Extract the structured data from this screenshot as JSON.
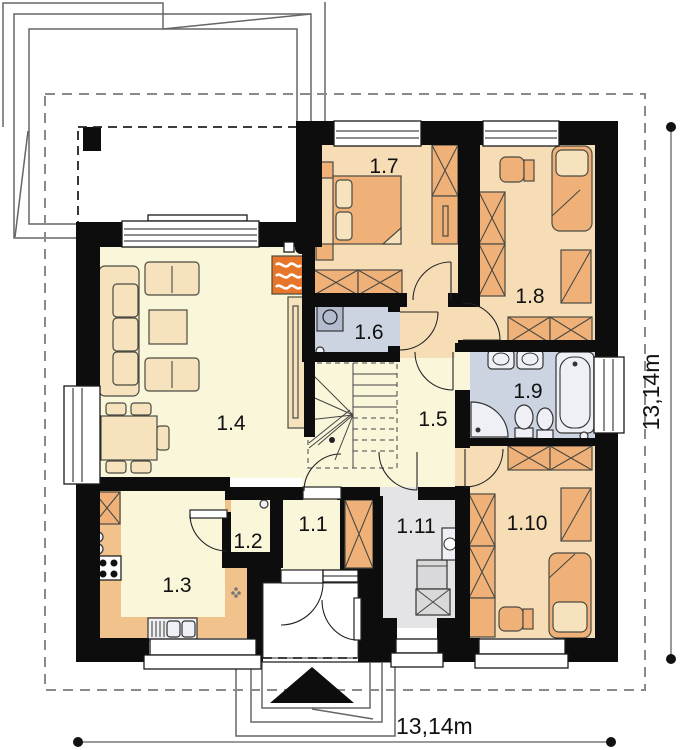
{
  "plan": {
    "dimension_bottom": "13,14m",
    "dimension_right": "13,14m",
    "rooms": [
      {
        "label": "1.1"
      },
      {
        "label": "1.2"
      },
      {
        "label": "1.3"
      },
      {
        "label": "1.4"
      },
      {
        "label": "1.5"
      },
      {
        "label": "1.6"
      },
      {
        "label": "1.7"
      },
      {
        "label": "1.8"
      },
      {
        "label": "1.9"
      },
      {
        "label": "1.10"
      },
      {
        "label": "1.11"
      }
    ],
    "colors": {
      "wall": "#0d0d0d",
      "floor_bedroom": "#f7ddb6",
      "floor_living": "#faf6da",
      "floor_kitchen": "#f2c28c",
      "floor_bathroom": "#ccd4e2",
      "floor_utility": "#e4e4e6",
      "furniture": "#f0b179",
      "furniture_light": "#f6e3bd",
      "fireplace": "#e8762a",
      "fixture": "#eef0f6",
      "appliance": "#d9d9db"
    }
  }
}
